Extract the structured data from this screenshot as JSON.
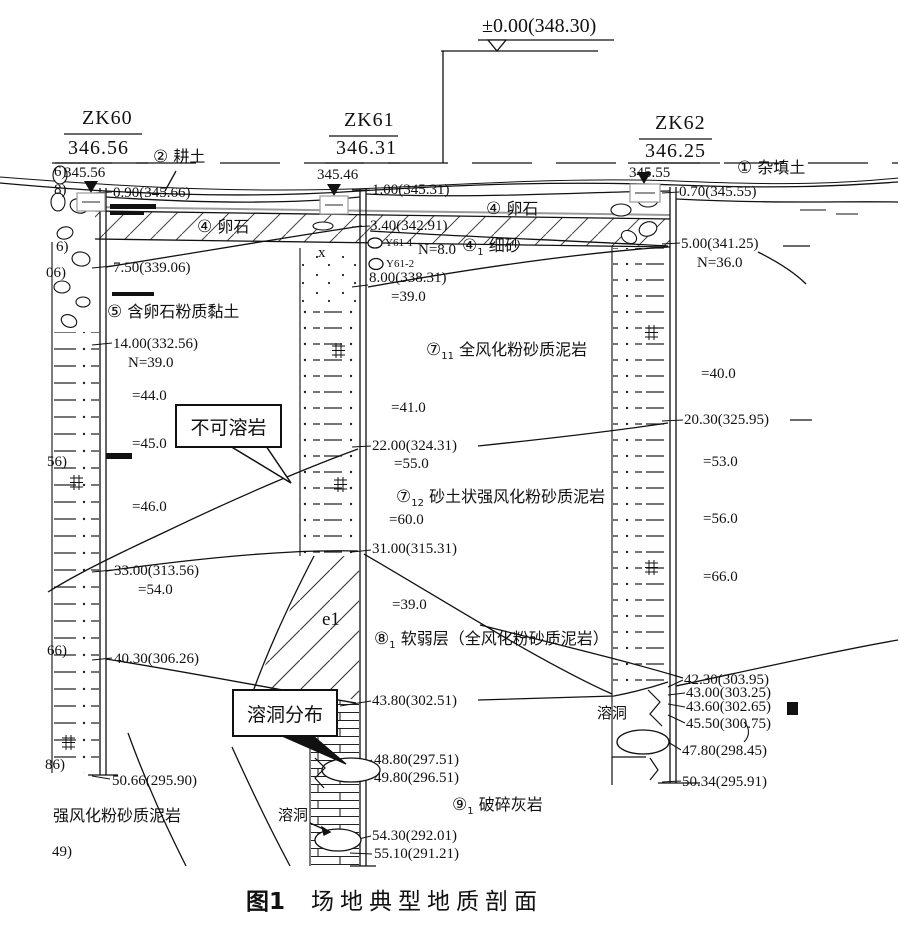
{
  "figure": {
    "label": "图1",
    "caption": "场地典型地质剖面"
  },
  "datum": {
    "label": "±0.00(348.30)"
  },
  "colors": {
    "line": "#111111",
    "paper": "#ffffff",
    "band_gray": "#9a9a9a"
  },
  "boreholes": [
    {
      "id": "ZK60",
      "top_elevation": "346.56",
      "water_elevation": "345.56"
    },
    {
      "id": "ZK61",
      "top_elevation": "346.31",
      "water_elevation": "345.46"
    },
    {
      "id": "ZK62",
      "top_elevation": "346.25",
      "water_elevation": "345.55"
    }
  ],
  "strata": [
    {
      "num": "②",
      "sub": "",
      "name": "耕土"
    },
    {
      "num": "①",
      "sub": "",
      "name": "杂填土"
    },
    {
      "num": "④",
      "sub": "",
      "name": "卵石"
    },
    {
      "num": "④",
      "sub": "",
      "name": "卵石"
    },
    {
      "num": "④",
      "sub": "1",
      "name": "细砂"
    },
    {
      "num": "⑤",
      "sub": "",
      "name": "含卵石粉质黏土"
    },
    {
      "num": "⑦",
      "sub": "11",
      "name": "全风化粉砂质泥岩"
    },
    {
      "num": "⑦",
      "sub": "12",
      "name": "砂土状强风化粉砂质泥岩"
    },
    {
      "num": "⑧",
      "sub": "1",
      "name": "软弱层（全风化粉砂质泥岩）"
    },
    {
      "num": "⑨",
      "sub": "1",
      "name": "破碎灰岩"
    }
  ],
  "zk60": [
    "0.90(345.66)",
    "7.50(339.06)",
    "14.00(332.56)",
    "N=39.0",
    "=44.0",
    "=45.0",
    "=46.0",
    "33.00(313.56)",
    "=54.0",
    "40.30(306.26)",
    "50.66(295.90)"
  ],
  "zk61": [
    "1.00(345.31)",
    "3.40(342.91)",
    "Y61-1",
    "N=8.0",
    "Y61-2",
    "8.00(338.31)",
    "=39.0",
    "=41.0",
    "22.00(324.31)",
    "=55.0",
    "=60.0",
    "31.00(315.31)",
    "=39.0",
    "43.80(302.51)",
    "48.80(297.51)",
    "49.80(296.51)",
    "54.30(292.01)",
    "55.10(291.21)"
  ],
  "zk62": [
    "0.70(345.55)",
    "5.00(341.25)",
    "N=36.0",
    "=40.0",
    "20.30(325.95)",
    "=53.0",
    "=56.0",
    "=66.0",
    "42.30(303.95)",
    "43.00(303.25)",
    "43.60(302.65)",
    "45.50(300.75)",
    "47.80(298.45)",
    "50.34(295.91)"
  ],
  "callouts": {
    "insoluble": "不可溶岩",
    "karst_dist": "溶洞分布"
  },
  "misc": {
    "karst_zk61": "溶洞",
    "karst_zk62": "溶洞",
    "e1": "e1",
    "x_mark": "x",
    "bottom_rock": "强风化粉砂质泥岩"
  },
  "edge": [
    "6)",
    "8)",
    "6)",
    "06)",
    "56)",
    "66)",
    "86)",
    "49)"
  ]
}
